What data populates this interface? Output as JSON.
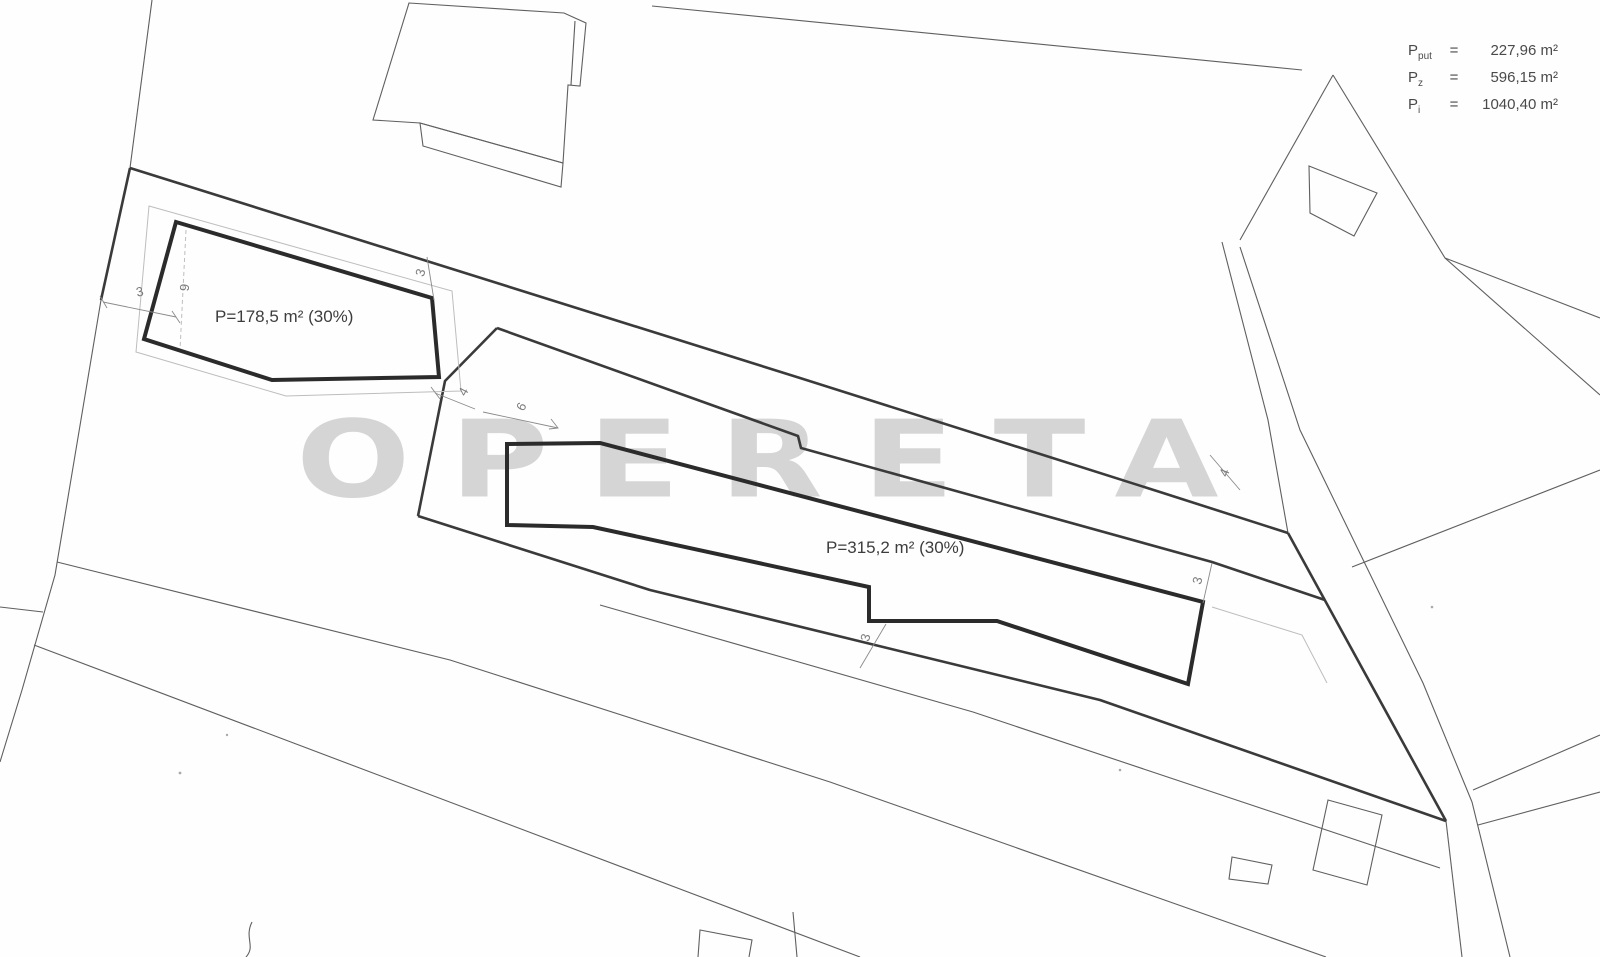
{
  "watermark": {
    "text": "OPERETA"
  },
  "legend": {
    "rows": [
      {
        "sym": "P",
        "sub": "put",
        "eq": "=",
        "val": "227,96 m²"
      },
      {
        "sym": "P",
        "sub": "z",
        "eq": "=",
        "val": "596,15 m²"
      },
      {
        "sym": "P",
        "sub": "i",
        "eq": "=",
        "val": "1040,40 m²"
      }
    ]
  },
  "parcels": [
    {
      "area_label": "P=178,5 m² (30%)"
    },
    {
      "area_label": "P=315,2 m² (30%)"
    }
  ],
  "dimensions": [
    {
      "value": "3"
    },
    {
      "value": "9"
    },
    {
      "value": "3"
    },
    {
      "value": "4"
    },
    {
      "value": "6"
    },
    {
      "value": "4"
    },
    {
      "value": "3"
    },
    {
      "value": "3"
    }
  ]
}
